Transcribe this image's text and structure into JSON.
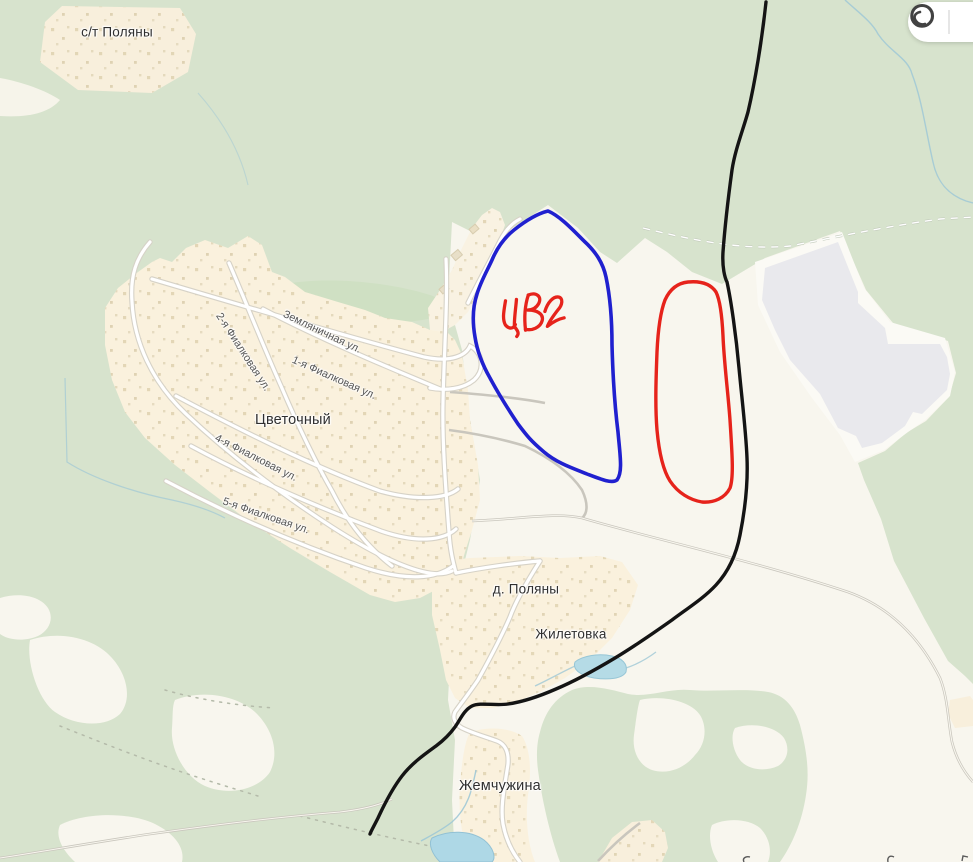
{
  "map": {
    "place_labels": [
      {
        "id": "st-polyany",
        "name": "с/т Поляны"
      },
      {
        "id": "tsvetochny",
        "name": "Цветочный"
      },
      {
        "id": "d-polyany",
        "name": "д. Поляны"
      },
      {
        "id": "zhiletovka",
        "name": "Жилетовка"
      },
      {
        "id": "zhemchuzhina",
        "name": "Жемчужина"
      }
    ],
    "street_labels": [
      {
        "name": "Земляничная ул."
      },
      {
        "name": "1-я Фиалковая ул."
      },
      {
        "name": "2-я Фиалковая ул."
      },
      {
        "name": "4-я Фиалковая ул."
      },
      {
        "name": "5-я Фиалковая ул."
      }
    ],
    "colors": {
      "forest": "#d7e3cd",
      "forest_dark": "#cfe0c3",
      "field": "#f8f6ee",
      "settlement": "#faf1dd",
      "road_fill": "#ffffff",
      "road_casing": "#d6d2c7",
      "water": "#aed8e6",
      "stream": "#9fc8d6",
      "industrial": "#e9e9ed"
    }
  },
  "annotations": {
    "handwritten_label": "ЦВ 2",
    "stroke_colors": {
      "outline_blue": "#2020cf",
      "outline_red": "#e6231b",
      "route_black": "#141414"
    }
  },
  "toolbar": {
    "tools": [
      {
        "name": "circle-tool"
      },
      {
        "name": "more-tool-partial"
      }
    ]
  }
}
